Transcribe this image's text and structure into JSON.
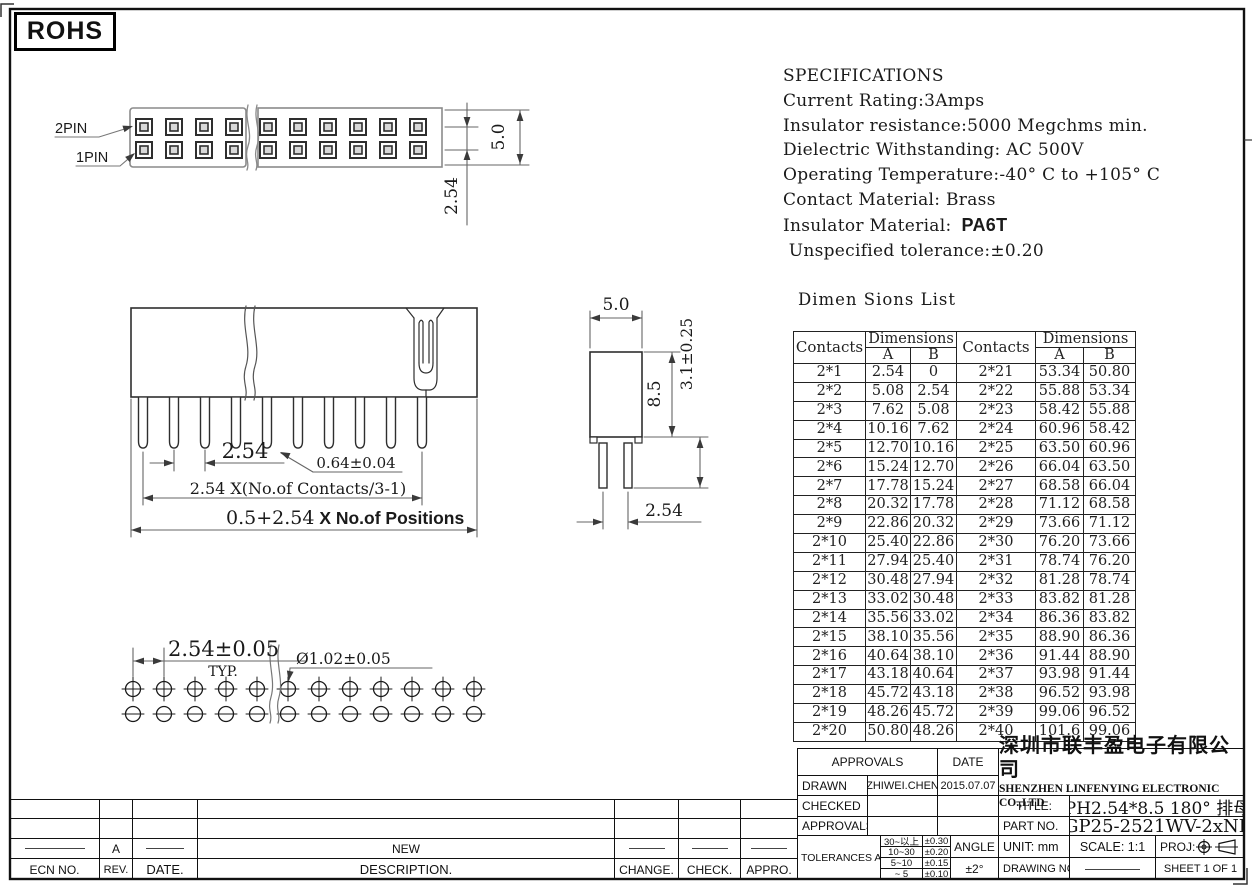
{
  "rohs_label": "ROHS",
  "specs": {
    "title": "SPECIFICATIONS",
    "lines": [
      "Current Rating:3Amps",
      "Insulator resistance:5000 Megchms min.",
      "Dielectric Withstanding: AC 500V",
      "Operating Temperature:-40° C to +105° C",
      "Contact Material: Brass"
    ],
    "insulator_material_label": "Insulator Material:",
    "insulator_material_value": "PA6T",
    "last_line": " Unspecified tolerance:±0.20"
  },
  "views": {
    "top": {
      "pin2_label": "2PIN",
      "pin1_label": "1PIN",
      "dim_depth": "5.0",
      "dim_row_pitch": "2.54"
    },
    "front": {
      "dim_pitch": "2.54",
      "dim_pin": "0.64±0.04",
      "dim_contacts": "2.54 X(No.of Contacts/3-1)",
      "dim_overall_a": "0.5+2.54",
      "dim_overall_b": " X No.of Positions"
    },
    "side": {
      "dim_width": "5.0",
      "dim_body": "8.5",
      "dim_tail": "3.1±0.25",
      "dim_pitch": "2.54"
    },
    "bottom": {
      "dim_pitch": "2.54±0.05",
      "typ_label": "TYP.",
      "dim_hole": "Ø1.02±0.05"
    }
  },
  "dim_table": {
    "title": "Dimen Sions List",
    "headers": {
      "contacts": "Contacts",
      "dimensions": "Dimensions",
      "a": "A",
      "b": "B"
    },
    "rows": [
      [
        "2*1",
        "2.54",
        "0",
        "2*21",
        "53.34",
        "50.80"
      ],
      [
        "2*2",
        "5.08",
        "2.54",
        "2*22",
        "55.88",
        "53.34"
      ],
      [
        "2*3",
        "7.62",
        "5.08",
        "2*23",
        "58.42",
        "55.88"
      ],
      [
        "2*4",
        "10.16",
        "7.62",
        "2*24",
        "60.96",
        "58.42"
      ],
      [
        "2*5",
        "12.70",
        "10.16",
        "2*25",
        "63.50",
        "60.96"
      ],
      [
        "2*6",
        "15.24",
        "12.70",
        "2*26",
        "66.04",
        "63.50"
      ],
      [
        "2*7",
        "17.78",
        "15.24",
        "2*27",
        "68.58",
        "66.04"
      ],
      [
        "2*8",
        "20.32",
        "17.78",
        "2*28",
        "71.12",
        "68.58"
      ],
      [
        "2*9",
        "22.86",
        "20.32",
        "2*29",
        "73.66",
        "71.12"
      ],
      [
        "2*10",
        "25.40",
        "22.86",
        "2*30",
        "76.20",
        "73.66"
      ],
      [
        "2*11",
        "27.94",
        "25.40",
        "2*31",
        "78.74",
        "76.20"
      ],
      [
        "2*12",
        "30.48",
        "27.94",
        "2*32",
        "81.28",
        "78.74"
      ],
      [
        "2*13",
        "33.02",
        "30.48",
        "2*33",
        "83.82",
        "81.28"
      ],
      [
        "2*14",
        "35.56",
        "33.02",
        "2*34",
        "86.36",
        "83.82"
      ],
      [
        "2*15",
        "38.10",
        "35.56",
        "2*35",
        "88.90",
        "86.36"
      ],
      [
        "2*16",
        "40.64",
        "38.10",
        "2*36",
        "91.44",
        "88.90"
      ],
      [
        "2*17",
        "43.18",
        "40.64",
        "2*37",
        "93.98",
        "91.44"
      ],
      [
        "2*18",
        "45.72",
        "43.18",
        "2*38",
        "96.52",
        "93.98"
      ],
      [
        "2*19",
        "48.26",
        "45.72",
        "2*39",
        "99.06",
        "96.52"
      ],
      [
        "2*20",
        "50.80",
        "48.26",
        "2*40",
        "101.6",
        "99.06"
      ]
    ]
  },
  "title_block": {
    "approvals_header": "APPROVALS",
    "date_header": "DATE",
    "drawn_label": "DRAWN",
    "drawn_by": "ZHIWEI.CHEN",
    "drawn_date": "2015.07.07",
    "checked_label": "CHECKED",
    "approvals_label": "APPROVALS",
    "tolerances_label": "TOLERANCES ARE",
    "tolerances": [
      [
        "30~以上",
        "±0.30"
      ],
      [
        "10~30",
        "±0.20"
      ],
      [
        "5~10",
        "±0.15"
      ],
      [
        "~ 5",
        "±0.10"
      ]
    ],
    "angle_label": "ANGLE",
    "angle_value": "±2°",
    "company_cn": "深圳市联丰盈电子有限公司",
    "company_en": "SHENZHEN LINFENYING ELECTRONIC CO.,LTD",
    "title_label": "TITLE:",
    "title_value": "PH2.54*8.5 180° 排母",
    "part_label": "PART NO.",
    "part_value": "GP25-2521WV-2xNP",
    "unit_label": "UNIT: mm",
    "scale_label": "SCALE: 1:1",
    "proj_label": "PROJ:",
    "drawing_no_label": "DRAWING NO.",
    "sheet_label": "SHEET 1 OF 1"
  },
  "revision": {
    "headers": [
      "ECN NO.",
      "REV.",
      "DATE.",
      "DESCRIPTION.",
      "CHANGE.",
      "CHECK.",
      "APPRO."
    ],
    "entry_rev": "A",
    "entry_description": "NEW"
  }
}
